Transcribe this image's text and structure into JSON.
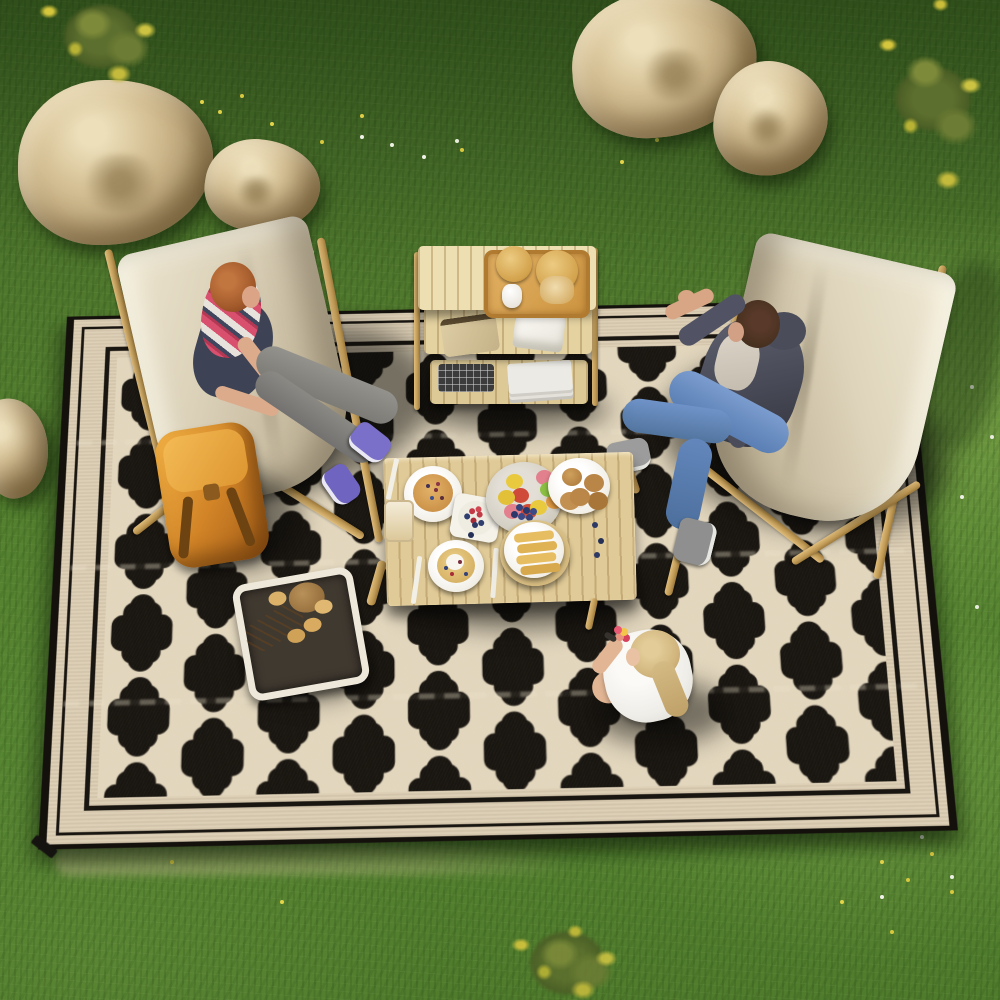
{
  "scene": {
    "title": "Overhead outdoor picnic on a black and cream quatrefoil rug",
    "description": "Top-down 3D render of a family picnic: a large black reversible outdoor rug with a cream Moroccan quatrefoil trellis pattern and striped cream border lies on green grass with beige boulders and yellow flowering bushes. Two beige sling chairs, a wooden picnic table with breakfast food, a three-tier wooden shelf with snack jars, a bread basket, an orange backpack, a seated woman, a lounging man, and a child sitting on the rug.",
    "environment": {
      "ground": {
        "label": "grass lawn",
        "colors": [
          "#3e6424",
          "#54812f",
          "#7fae4e"
        ],
        "details": "denser olive grass at top, sunlit lighter strip along right edge, pale dry patch under rug bottom edge"
      },
      "rocks": {
        "label": "beige boulders",
        "items": [
          {
            "name": "large boulder upper left",
            "approx": [
              18,
              80,
              195,
              165
            ]
          },
          {
            "name": "small boulder upper left",
            "approx": [
              205,
              140,
              115,
              92
            ]
          },
          {
            "name": "large boulder top middle",
            "approx": [
              572,
              0,
              185,
              140
            ]
          },
          {
            "name": "small boulder top middle",
            "approx": [
              715,
              62,
              115,
              115
            ]
          },
          {
            "name": "small rock at left edge",
            "approx": [
              -18,
              398,
              68,
              100
            ]
          }
        ],
        "colors": [
          "#ecdfba",
          "#bda67a",
          "#6f5c38"
        ]
      },
      "vegetation": [
        {
          "name": "yellow flowering bush top left",
          "color": "#cdc342"
        },
        {
          "name": "yellow flowering bush top right",
          "color": "#cdc342"
        },
        {
          "name": "yellow-green shrub bottom center",
          "color": "#c4ba3c"
        },
        {
          "name": "scattered yellow and white wildflowers",
          "colors": [
            "#e4d44a",
            "#f2f2ea"
          ]
        }
      ]
    },
    "rug": {
      "label": "black and cream quatrefoil outdoor rug",
      "field_color": "#191510",
      "pattern_color": "#e2d6bd",
      "pattern": "Moroccan quatrefoil trellis lattice, offset rows of lantern-shaped black cells outlined in cream",
      "border": "cream band, thin black pinstripe, wide cream band, black line, cream inner line; thin black edge binding; black corner loop tab at lower left",
      "details": "three faint horizontal fold creases across the rug"
    },
    "objects": {
      "chair_left": {
        "label": "beige sling chair with wooden frame (upper left)",
        "canvas_color": "#dcd2ba",
        "frame_color": "#c09a55"
      },
      "chair_right": {
        "label": "beige sling chair with wooden frame (right)",
        "canvas_color": "#ded4bb",
        "frame_color": "#c09a55"
      },
      "shelf": {
        "label": "three-tier folding wooden camp shelf",
        "color": "#e7d6a4",
        "items": [
          "wicker serving tray",
          "two glass snack jars with cracker lids",
          "white creamer pitcher",
          "snack bag",
          "white napkins",
          "black wire basket",
          "stack of white books"
        ]
      },
      "table": {
        "label": "low wooden slat picnic table",
        "color": "#e0ca97",
        "items": [
          "plate of berry pancakes",
          "square plate with bowl of strawberries and blueberries",
          "platter of mixed fruit",
          "plate of buns",
          "pancake with cream plate",
          "round board with french toast sticks",
          "jar of snacks",
          "white cutlery",
          "scattered blueberries"
        ]
      },
      "bread_basket": {
        "label": "fabric-lined basket of breads",
        "colors": [
          "#f3efe6",
          "#d2a45c"
        ]
      },
      "backpack": {
        "label": "orange canvas backpack beside left chair",
        "color": "#d28427"
      }
    },
    "people": {
      "woman": {
        "label": "woman with auburn hair seated cross-legged in left chair",
        "clothing": "pink and white striped scarf, dark top, gray jeans, purple sneakers"
      },
      "man": {
        "label": "man lounging in right chair pointing upward",
        "clothing": "dark gray hoodie over light tee, blue jeans, gray sneakers"
      },
      "child": {
        "label": "blonde child with ponytail sitting on rug eating a snack",
        "clothing": "white t-shirt"
      }
    },
    "palette": {
      "rug_black": "#191510",
      "rug_cream": "#ddd0b7",
      "grass_green": "#54812f",
      "wood_tan": "#e0ca97",
      "canvas_beige": "#dcd2ba",
      "backpack_orange": "#d28427",
      "jeans_blue": "#6f93c8",
      "rock_beige": "#d6c196"
    }
  }
}
